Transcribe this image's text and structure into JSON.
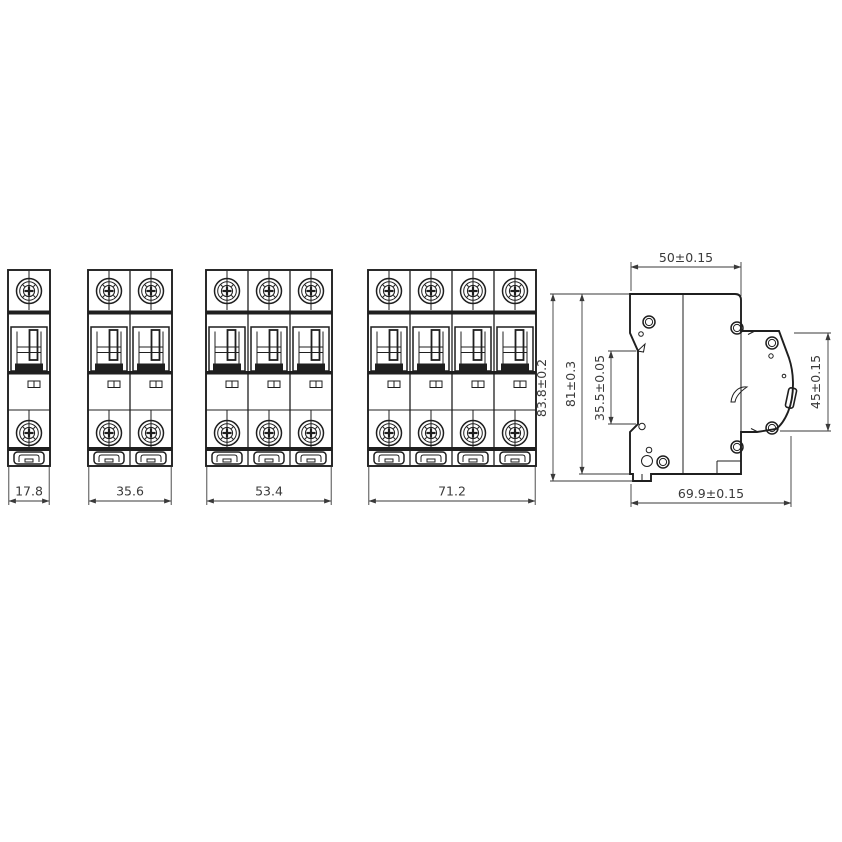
{
  "drawing_type": "circuit-breaker dimensional drawing",
  "front_views": [
    {
      "name": "1-pole breaker front view",
      "poles": 1,
      "width_label": "17.8"
    },
    {
      "name": "2-pole breaker front view",
      "poles": 2,
      "width_label": "35.6"
    },
    {
      "name": "3-pole breaker front view",
      "poles": 3,
      "width_label": "53.4"
    },
    {
      "name": "4-pole breaker front view",
      "poles": 4,
      "width_label": "71.2"
    }
  ],
  "side_view": {
    "top_width_label": "50±0.15",
    "overall_height_label": "83.8±0.2",
    "body_height_label": "81±0.3",
    "din_recess_label": "35.5±0.05",
    "front_face_height_label": "45±0.15",
    "overall_depth_label": "69.9±0.15"
  },
  "colors": {
    "line": "#1f1f1f",
    "dimension": "#3a3a3a",
    "background": "#ffffff"
  }
}
